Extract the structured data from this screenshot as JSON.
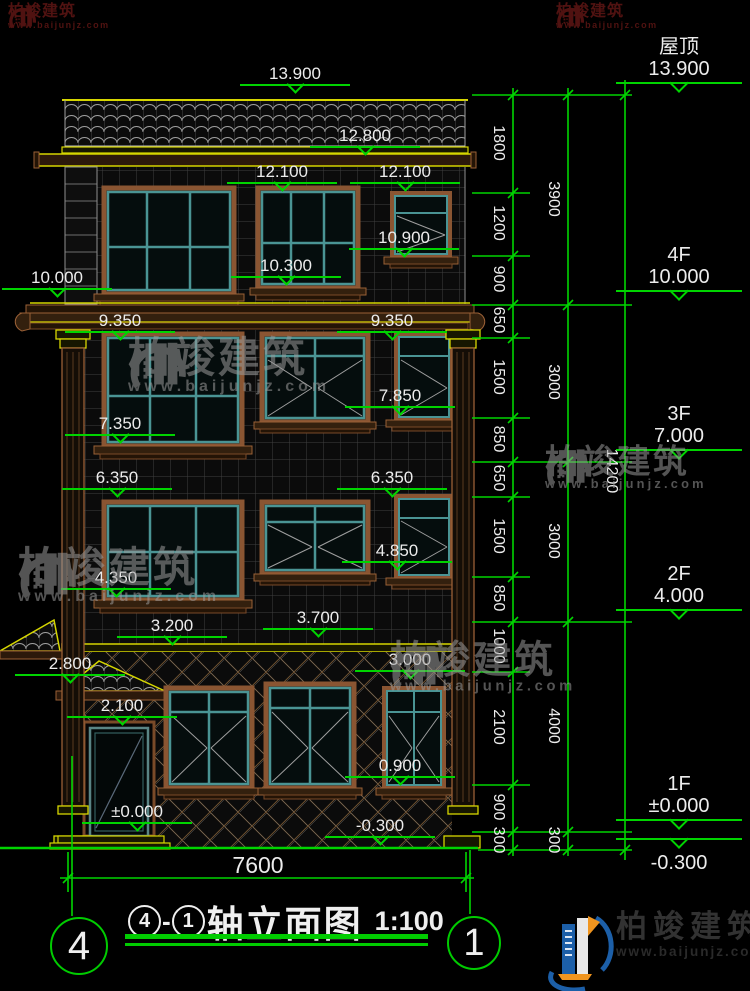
{
  "title": {
    "bubble_left": "4",
    "separator": "-",
    "bubble_right": "1",
    "text": "轴立面图",
    "scale": "1:100"
  },
  "axis": {
    "left": "4",
    "right": "1"
  },
  "levels": [
    "13.900",
    "12.800",
    "12.100",
    "12.100",
    "10.900",
    "10.300",
    "10.000",
    "9.350",
    "9.350",
    "7.850",
    "7.350",
    "6.350",
    "6.350",
    "4.850",
    "4.350",
    "3.700",
    "3.200",
    "3.000",
    "2.800",
    "2.100",
    "0.900",
    "±0.000",
    "-0.300"
  ],
  "floors": [
    {
      "name": "屋顶",
      "level": "13.900"
    },
    {
      "name": "4F",
      "level": "10.000"
    },
    {
      "name": "3F",
      "level": "7.000"
    },
    {
      "name": "2F",
      "level": "4.000"
    },
    {
      "name": "1F",
      "level": "±0.000"
    },
    {
      "name": "",
      "level": "-0.300"
    }
  ],
  "dims": {
    "right_outer": [
      "1800",
      "1200",
      "900",
      "650",
      "1500",
      "850",
      "650",
      "1500",
      "850",
      "1000",
      "2100",
      "900",
      "300"
    ],
    "right_inner": [
      "3900",
      "3000",
      "3000",
      "4000",
      "300"
    ],
    "overall_height": "14200",
    "overall_width": "7600"
  },
  "watermark": {
    "brand": "柏竣建筑",
    "url": "www.baijunjz.com"
  },
  "logo": {
    "brand": "柏竣建筑",
    "url": "www.baijunjz.com"
  }
}
